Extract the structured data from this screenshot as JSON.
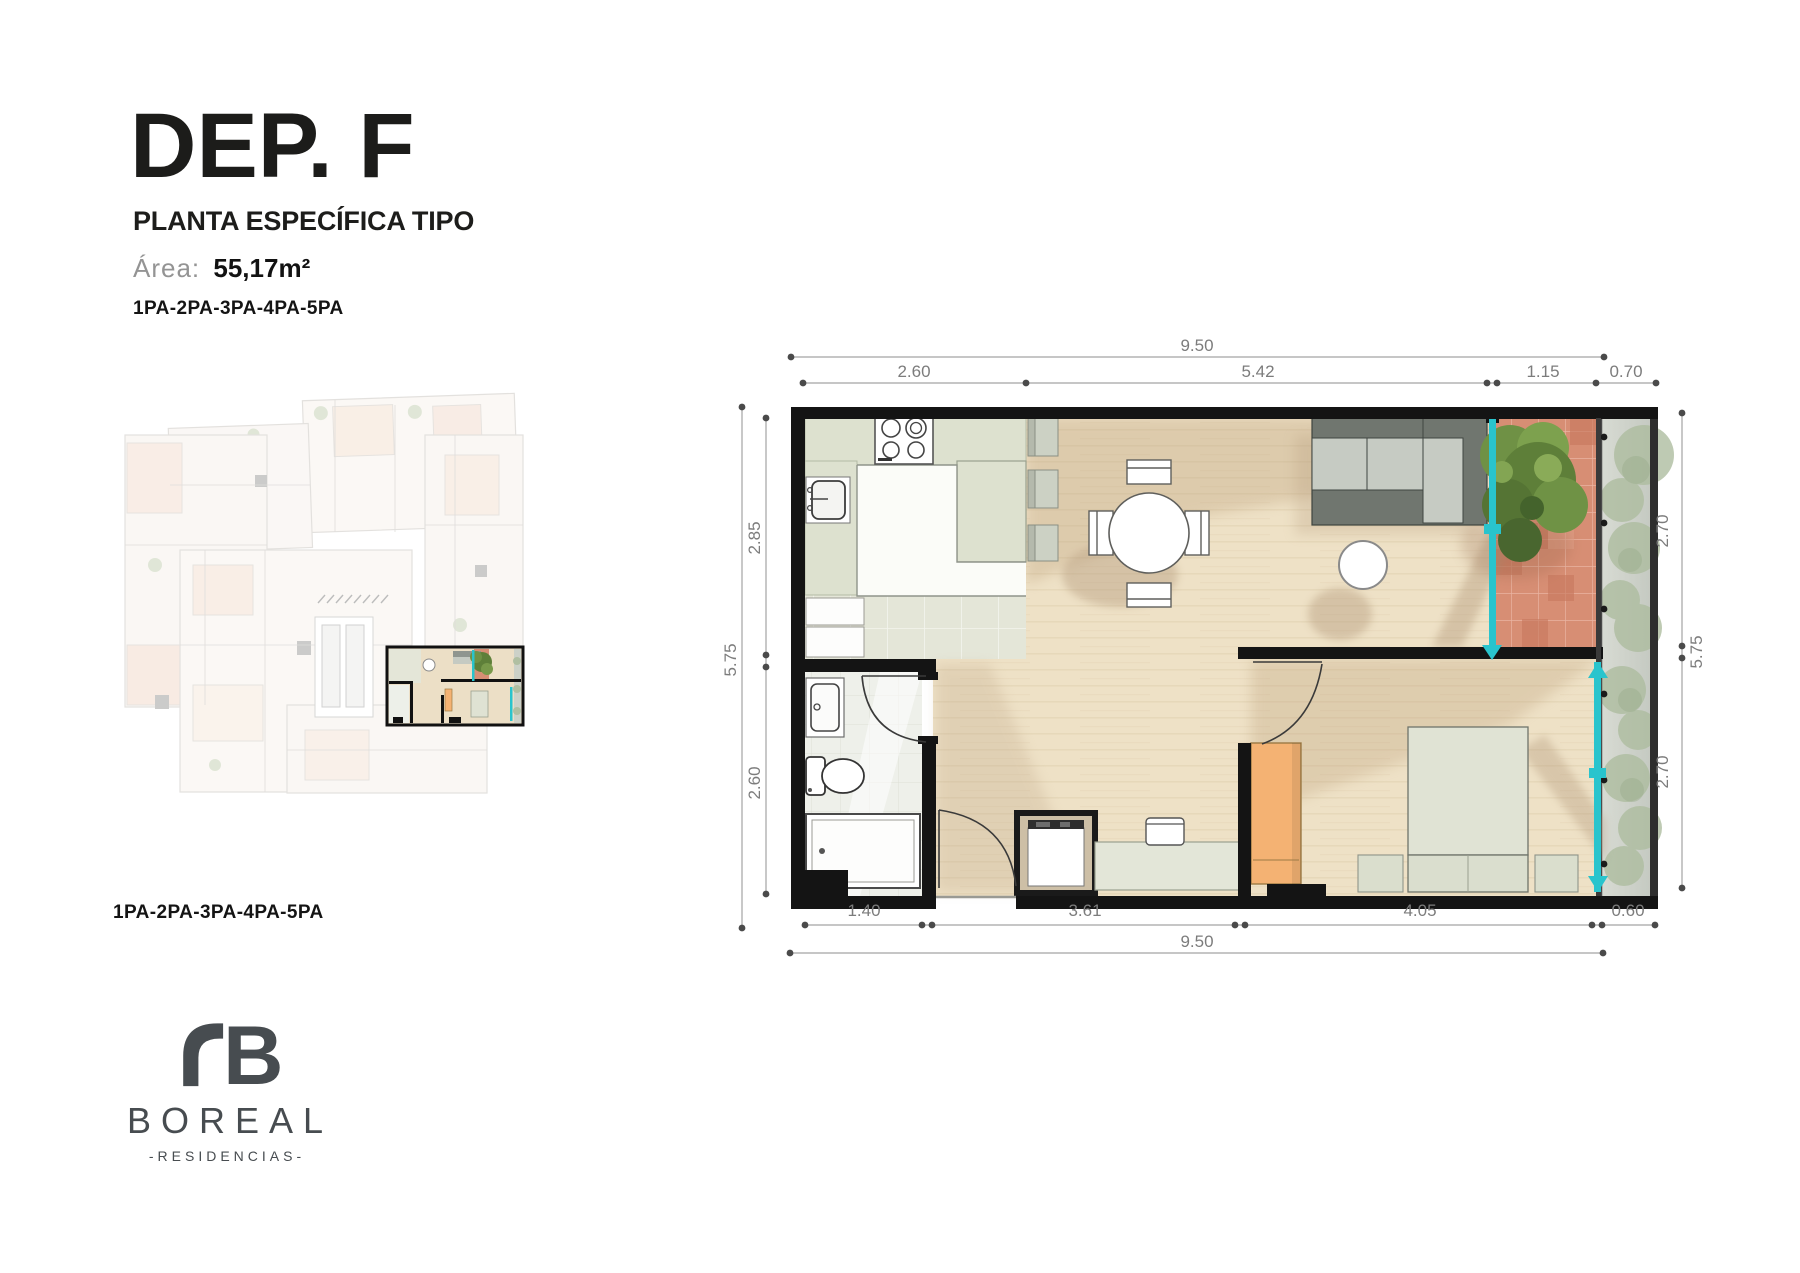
{
  "header": {
    "title": "DEP. F",
    "subtitle": "PLANTA ESPECÍFICA TIPO",
    "area_label": "Área:",
    "area_value": "55,17m²",
    "levels": "1PA-2PA-3PA-4PA-5PA"
  },
  "mini_plan": {
    "levels_caption": "1PA-2PA-3PA-4PA-5PA"
  },
  "brand": {
    "name": "BOREAL",
    "tagline": "-RESIDENCIAS-"
  },
  "plan": {
    "dims": {
      "top_total": "9.50",
      "top_segs": [
        "2.60",
        "5.42",
        "1.15",
        "0.70"
      ],
      "left": [
        "2.85",
        "5.75",
        "2.60"
      ],
      "right": [
        "2.70",
        "5.75",
        "2.70"
      ],
      "bottom_segs": [
        "1.40",
        "3.61",
        "4.05",
        "0.60"
      ],
      "bottom_total": "9.50"
    }
  },
  "colors": {
    "wall_black": "#141414",
    "accent_teal": "#29c4cd",
    "wood_floor": "#eee1c6",
    "kitchen_sage": "#e4e6d8",
    "bath_gray": "#eef0ea",
    "terracotta": "#d78e74",
    "tree_green": "#5e7f39",
    "planter_gray": "#d3d6cf",
    "bush_green": "#b0bfa2",
    "wardrobe_orange": "#f4b273",
    "brand_gray": "#474c50",
    "dim_gray": "#7c7c7c"
  }
}
